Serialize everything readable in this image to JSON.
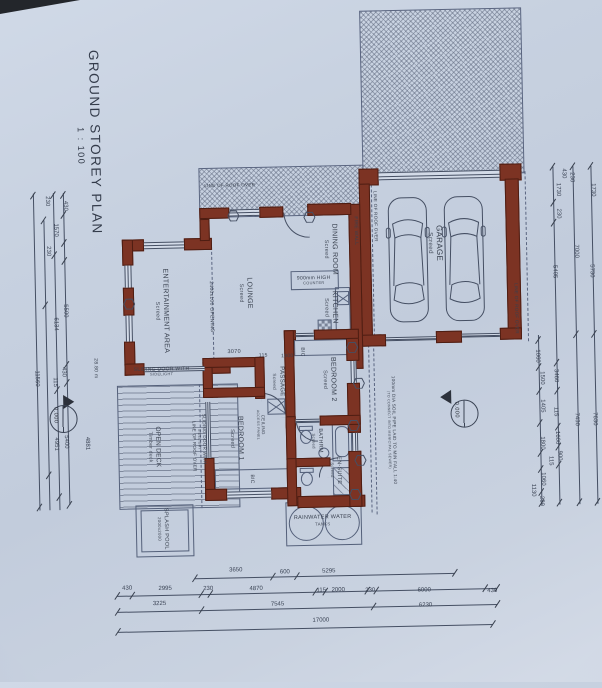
{
  "title": {
    "text": "GROUND STOREY PLAN",
    "scale": "1 : 100"
  },
  "rooms": [
    {
      "name": "garage-label",
      "lines": [
        "GARAGE",
        "Screed"
      ],
      "x": 437,
      "y": 246,
      "v": 1,
      "s": 8
    },
    {
      "name": "dining-room-label",
      "lines": [
        "DINING ROOM",
        "Screed"
      ],
      "x": 332,
      "y": 250,
      "v": 1,
      "s": 7
    },
    {
      "name": "kitchen-label",
      "lines": [
        "KITCHEN",
        "Screed"
      ],
      "x": 331,
      "y": 308,
      "v": 1,
      "s": 7
    },
    {
      "name": "lounge-label",
      "lines": [
        "LOUNGE",
        "Screed"
      ],
      "x": 246,
      "y": 292,
      "v": 1,
      "s": 7
    },
    {
      "name": "entertainment-area-label",
      "lines": [
        "ENTERTAINMENT AREA",
        "Screed"
      ],
      "x": 162,
      "y": 308,
      "v": 1,
      "s": 7
    },
    {
      "name": "passage-label",
      "lines": [
        "PASSAGE",
        "Screed"
      ],
      "x": 277,
      "y": 381,
      "v": 1,
      "s": 6
    },
    {
      "name": "bedroom2-label",
      "lines": [
        "BEDROOM 2",
        "Screed"
      ],
      "x": 328,
      "y": 380,
      "v": 1,
      "s": 7
    },
    {
      "name": "bedroom1-label",
      "lines": [
        "BEDROOM 1",
        "Screed"
      ],
      "x": 234,
      "y": 437,
      "v": 1,
      "s": 7
    },
    {
      "name": "bathroom-label",
      "lines": [
        "BATHRM",
        "Screed"
      ],
      "x": 315,
      "y": 441,
      "v": 1,
      "s": 5.5
    },
    {
      "name": "ensuite-label",
      "lines": [
        "EN-SUITE",
        "Screed"
      ],
      "x": 333,
      "y": 471,
      "v": 1,
      "s": 5.5
    },
    {
      "name": "open-deck-label",
      "lines": [
        "OPEN DECK",
        "Timber deck"
      ],
      "x": 152,
      "y": 444,
      "v": 1,
      "s": 6.5
    },
    {
      "name": "splash-pool-label",
      "lines": [
        "SPLASH POOL",
        "2000x2000"
      ],
      "x": 159,
      "y": 526,
      "v": 1,
      "s": 5.5
    },
    {
      "name": "rainwater-tanks-label",
      "lines": [
        "RAINWATER WATER",
        "TANKS"
      ],
      "x": 319,
      "y": 521,
      "v": 0,
      "s": 5.5
    }
  ],
  "annotations": [
    {
      "name": "fire-wall-note",
      "lines": [
        "FIRE WALL"
      ],
      "x": 358,
      "y": 232,
      "v": 1,
      "s": 5
    },
    {
      "name": "opening-note",
      "lines": [
        "2400x100 OPENING"
      ],
      "x": 212,
      "y": 305,
      "v": 1,
      "s": 5
    },
    {
      "name": "sliding-door-note-entertainment",
      "lines": [
        "SLIDING DOOR WITH",
        "SIDELIGHT"
      ],
      "x": 161,
      "y": 369,
      "v": 0,
      "s": 5
    },
    {
      "name": "sliding-door-note-bedroom1",
      "lines": [
        "SLIDING DOOR WITH",
        "SIDELIGHT"
      ],
      "x": 200,
      "y": 437,
      "v": 1,
      "s": 4.5
    },
    {
      "name": "ceiling-access-note",
      "lines": [
        "CEILING",
        "ACCESS PANEL"
      ],
      "x": 259,
      "y": 424,
      "v": 1,
      "s": 4.5
    },
    {
      "name": "counter-note",
      "lines": [
        "900mm HIGH",
        "COUNTER"
      ],
      "x": 315,
      "y": 281,
      "v": 0,
      "s": 5
    },
    {
      "name": "bic-note-bedroom2",
      "lines": [
        "BIC"
      ],
      "x": 302,
      "y": 352,
      "v": 1,
      "s": 5
    },
    {
      "name": "bic-note-bedroom1",
      "lines": [
        "BIC"
      ],
      "x": 249,
      "y": 478,
      "v": 1,
      "s": 5
    },
    {
      "name": "roof-over-note-top",
      "lines": [
        "LINE OF ROOF OVER"
      ],
      "x": 233,
      "y": 184,
      "v": 0,
      "s": 4.5
    },
    {
      "name": "roof-over-note-garage-left",
      "lines": [
        "LINE OF ROOF OVER"
      ],
      "x": 378,
      "y": 218,
      "v": 1,
      "s": 4.5
    },
    {
      "name": "roof-over-note-garage-right",
      "lines": [
        "LINE OF ROOF OVER"
      ],
      "x": 517,
      "y": 313,
      "v": 1,
      "s": 4.5
    },
    {
      "name": "roof-over-note-deck",
      "lines": [
        "LINE OF ROOF OVER"
      ],
      "x": 192,
      "y": 444,
      "v": 1,
      "s": 4.5
    },
    {
      "name": "soil-pipe-note",
      "lines": [
        "100mm DIA SOIL PIPE LAID TO MIN FALL 1:40",
        "(TO CONNECT INTO MUNICIPAL SEWER)"
      ],
      "x": 390,
      "y": 432,
      "v": 1,
      "s": 4.5
    },
    {
      "name": "area-note",
      "lines": [
        "28.80 m"
      ],
      "x": 95,
      "y": 364,
      "v": 1,
      "s": 5
    },
    {
      "name": "dim-3070",
      "lines": [
        "3070"
      ],
      "x": 234,
      "y": 351,
      "v": 0,
      "s": 5.5
    },
    {
      "name": "dim-115-passage",
      "lines": [
        "115"
      ],
      "x": 263,
      "y": 355,
      "v": 0,
      "s": 5
    },
    {
      "name": "dim-1000-passage",
      "lines": [
        "1000"
      ],
      "x": 287,
      "y": 356,
      "v": 0,
      "s": 5
    }
  ],
  "markers": [
    {
      "name": "datum-marker-left",
      "value": "0.000",
      "x": 62,
      "y": 414,
      "dir": "right"
    },
    {
      "name": "datum-marker-right",
      "value": "0.000",
      "x": 463,
      "y": 417,
      "dir": "left"
    }
  ],
  "dimensions": {
    "bottom": [
      {
        "x": 231,
        "y": 569,
        "t": "3650"
      },
      {
        "x": 280,
        "y": 572,
        "t": "600"
      },
      {
        "x": 324,
        "y": 572,
        "t": "5295"
      },
      {
        "x": 122,
        "y": 585,
        "t": "430"
      },
      {
        "x": 160,
        "y": 586,
        "t": "2995"
      },
      {
        "x": 203,
        "y": 587,
        "t": "230"
      },
      {
        "x": 251,
        "y": 588,
        "t": "4870"
      },
      {
        "x": 316,
        "y": 591,
        "t": "115"
      },
      {
        "x": 333,
        "y": 591,
        "t": "2000"
      },
      {
        "x": 365,
        "y": 592,
        "t": "230"
      },
      {
        "x": 419,
        "y": 593,
        "t": "6000"
      },
      {
        "x": 487,
        "y": 595,
        "t": "430"
      },
      {
        "x": 154,
        "y": 601,
        "t": "3225"
      },
      {
        "x": 272,
        "y": 604,
        "t": "7545"
      },
      {
        "x": 420,
        "y": 608,
        "t": "6230"
      },
      {
        "x": 315,
        "y": 621,
        "t": "17000"
      }
    ],
    "left": [
      {
        "x": 50,
        "y": 196,
        "t": "230"
      },
      {
        "x": 58,
        "y": 225,
        "t": "1570"
      },
      {
        "x": 68,
        "y": 201,
        "t": "430"
      },
      {
        "x": 50,
        "y": 246,
        "t": "230"
      },
      {
        "x": 66,
        "y": 306,
        "t": "5500"
      },
      {
        "x": 56,
        "y": 319,
        "t": "6134"
      },
      {
        "x": 36,
        "y": 373,
        "t": "11560"
      },
      {
        "x": 63,
        "y": 367,
        "t": "430"
      },
      {
        "x": 54,
        "y": 377,
        "t": "115"
      },
      {
        "x": 64,
        "y": 437,
        "t": "5400"
      },
      {
        "x": 54,
        "y": 439,
        "t": "4951"
      },
      {
        "x": 85,
        "y": 439,
        "t": "4881"
      }
    ],
    "right": [
      {
        "x": 567,
        "y": 179,
        "t": "430"
      },
      {
        "x": 575,
        "y": 183,
        "t": "230"
      },
      {
        "x": 561,
        "y": 195,
        "t": "1730"
      },
      {
        "x": 596,
        "y": 196,
        "t": "1730"
      },
      {
        "x": 561,
        "y": 219,
        "t": "230"
      },
      {
        "x": 578,
        "y": 257,
        "t": "7000"
      },
      {
        "x": 556,
        "y": 277,
        "t": "5405"
      },
      {
        "x": 593,
        "y": 277,
        "t": "5730"
      },
      {
        "x": 537,
        "y": 361,
        "t": "1060"
      },
      {
        "x": 541,
        "y": 383,
        "t": "1500"
      },
      {
        "x": 555,
        "y": 381,
        "t": "3460"
      },
      {
        "x": 541,
        "y": 411,
        "t": "1405"
      },
      {
        "x": 554,
        "y": 417,
        "t": "115"
      },
      {
        "x": 575,
        "y": 425,
        "t": "7430"
      },
      {
        "x": 593,
        "y": 425,
        "t": "7630"
      },
      {
        "x": 555,
        "y": 443,
        "t": "1600"
      },
      {
        "x": 540,
        "y": 448,
        "t": "1800"
      },
      {
        "x": 557,
        "y": 461,
        "t": "900"
      },
      {
        "x": 548,
        "y": 466,
        "t": "115"
      },
      {
        "x": 540,
        "y": 484,
        "t": "1060"
      },
      {
        "x": 530,
        "y": 495,
        "t": "1130"
      },
      {
        "x": 538,
        "y": 506,
        "t": "230"
      }
    ]
  },
  "colors": {
    "wall": "#7c3323",
    "paper": "#c7d1e0",
    "ink": "#454f63"
  }
}
